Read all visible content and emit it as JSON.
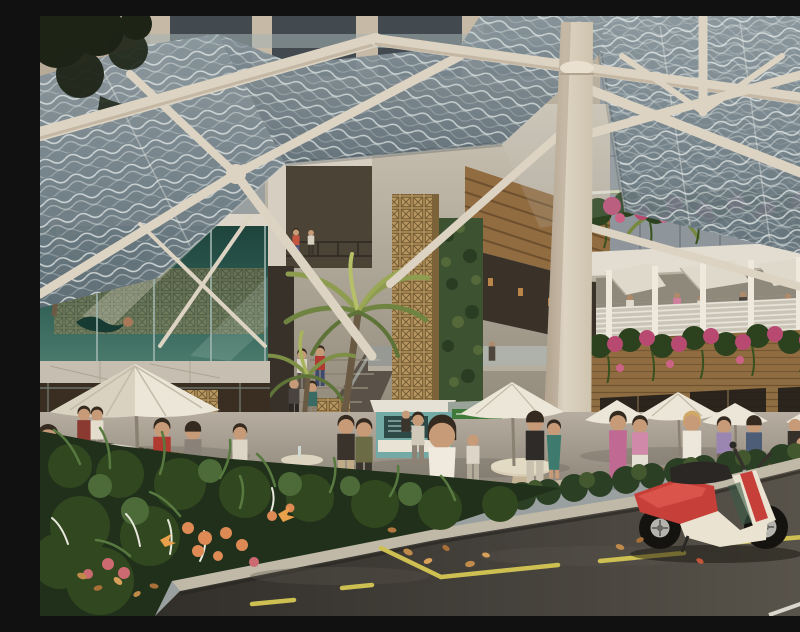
{
  "scene": {
    "title": "Architectural rendering: street view of a mixed-use retail precinct with sculptural white canopy",
    "medium": "photorealistic render, no text or UI elements visible",
    "labels": {
      "canopy": "perforated wave-patterned glass canopy screens",
      "structure": "white branching tubular steel canopy structure",
      "column": "large white canopy mast column",
      "tower": "residential tower facade above canopy",
      "atrium": "multi-level retail atrium with palms, stairs and green wall",
      "pool_box": "elevated green-glass lap pool with swimmer",
      "left_bar": "ground floor bar with umbrella, counter and stools",
      "right_building": "two-storey timber restaurant pavilion with balcony diners",
      "flower_planters": "cascading pink bougainvillea planter boxes",
      "terrace": "outdoor dining terrace with white market umbrellas",
      "crowd": "pedestrians strolling, shopping and dining",
      "kiosk": "teal food kiosk with menu board",
      "garden": "foreground garden bed with tropical flowers",
      "road": "asphalt street with yellow lane markings, white edge line and fallen leaves",
      "scooter": "red and cream scooter parked at the kerb"
    },
    "counts": {
      "umbrellas": 6,
      "people_approx": 35,
      "scooters": 1,
      "palm_trees": 3
    }
  },
  "palette": {
    "structure_white": "#ddd3c2",
    "structure_shadow": "#ab9d88",
    "canopy_glass": "#5f6e77",
    "canopy_glass_light": "#8b989e",
    "canopy_pattern": "#e3e9e7",
    "tower_facade": "#b7aa97",
    "tower_window": "#434a4f",
    "atrium_wall": "#cbc3b4",
    "atrium_dark": "#31291f",
    "timber": "#916c41",
    "timber_dark": "#5f4526",
    "green_wall": "#3d5230",
    "palm_green": "#8d9c4f",
    "glassbox_green": "#2e5c52",
    "breeze_block": "#b5975f",
    "marble": "#c6bfb1",
    "balcony_white": "#e7e3d8",
    "bougainvillea": "#b84a72",
    "foliage_dark": "#2c421f",
    "flower_orange": "#dd8a55",
    "umbrella_white": "#ece6d8",
    "terrace_floor": "#a59c90",
    "kiosk_teal": "#74aaa5",
    "hedge_green": "#2b3f24",
    "road_asphalt": "#46423c",
    "road_dark": "#322f2a",
    "curb_concrete": "#c1b9a7",
    "lane_yellow": "#cdbf52",
    "lane_white": "#d9d6cc",
    "scooter_red": "#c63f38",
    "scooter_cream": "#eae3d2",
    "leaf_litter": "#c08a4a",
    "skin": "#c79a78"
  }
}
